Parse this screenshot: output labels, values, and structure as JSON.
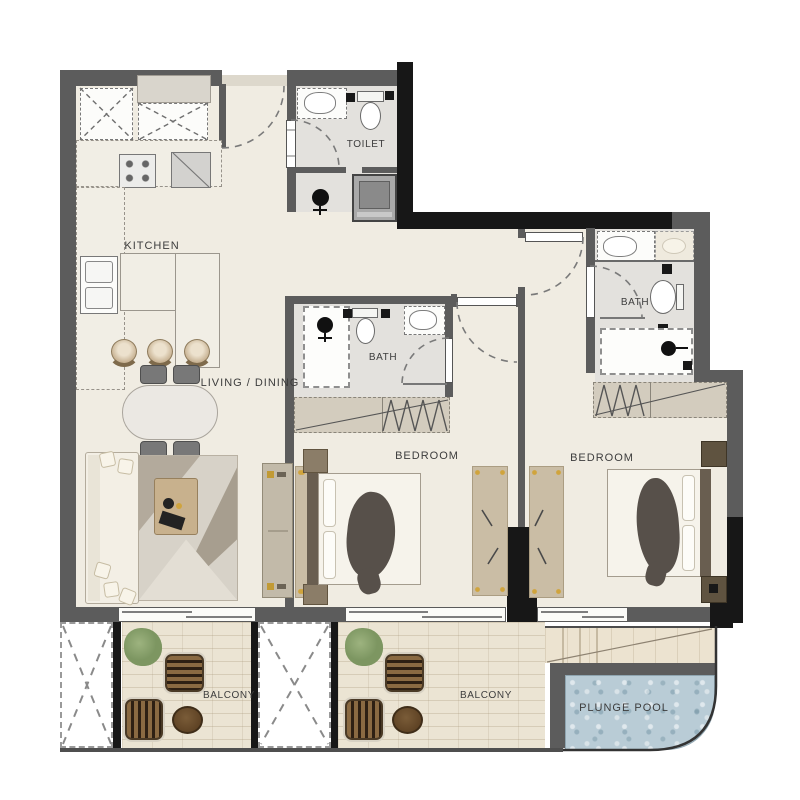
{
  "rooms": {
    "kitchen": {
      "label": "KITCHEN"
    },
    "toilet": {
      "label": "TOILET"
    },
    "living_dining": {
      "label": "LIVING / DINING"
    },
    "bath1": {
      "label": "BATH"
    },
    "bath2": {
      "label": "BATH"
    },
    "bedroom1": {
      "label": "BEDROOM"
    },
    "bedroom2": {
      "label": "BEDROOM"
    },
    "balcony1": {
      "label": "BALCONY"
    },
    "balcony2": {
      "label": "BALCONY"
    },
    "plunge_pool": {
      "label": "PLUNGE POOL"
    }
  },
  "colors": {
    "wall_gray": "#5c5c5c",
    "wall_black": "#171717",
    "floor_cream": "#f0ece2",
    "bath_floor": "#e3e1dd",
    "balcony_floor": "#ebe4d3",
    "pool_water": "#b9ccd6",
    "rattan_wood": "#8a6a42",
    "plant_green": "#7f9a62",
    "rug_gold_accent": "#d0a43c",
    "label_text": "#3d3d3d"
  }
}
